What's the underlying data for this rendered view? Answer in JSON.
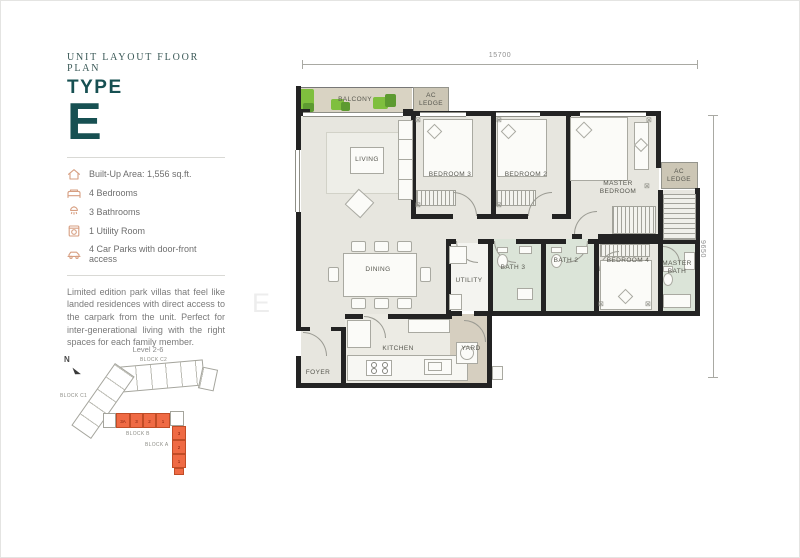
{
  "header": {
    "eyebrow": "UNIT LAYOUT FLOOR PLAN",
    "type_label": "TYPE",
    "type_letter": "E"
  },
  "features": {
    "items": [
      {
        "icon": "home-icon",
        "text": "Built-Up Area: 1,556 sq.ft."
      },
      {
        "icon": "bed-icon",
        "text": "4 Bedrooms"
      },
      {
        "icon": "shower-icon",
        "text": "3 Bathrooms"
      },
      {
        "icon": "washer-icon",
        "text": "1 Utility Room"
      },
      {
        "icon": "car-icon",
        "text": "4 Car Parks with door-front access"
      }
    ]
  },
  "description": "Limited edition park villas that feel like landed residences with direct access to the carpark from the unit. Perfect for inter-generational living with the right spaces for each family member.",
  "sitemap": {
    "title": "Level 2-6",
    "north_label": "N",
    "blocks": {
      "c2": "BLOCK C2",
      "c1": "BLOCK C1",
      "b": "BLOCK B",
      "a": "BLOCK A"
    },
    "block_b_units": [
      "3A",
      "3",
      "2",
      "1"
    ],
    "block_a_units": [
      "3",
      "2",
      "1"
    ]
  },
  "plan": {
    "dim_top": "15700",
    "dim_right": "9650",
    "rooms": {
      "balcony": "BALCONY",
      "ac_ledge_top": "AC LEDGE",
      "living": "LIVING",
      "bedroom3": "BEDROOM 3",
      "bedroom2": "BEDROOM 2",
      "master_bedroom": "MASTER BEDROOM",
      "ac_ledge_right": "AC LEDGE",
      "dining": "DINING",
      "utility": "UTILITY",
      "bath3": "BATH 3",
      "bath2": "BATH 2",
      "bedroom4": "BEDROOM 4",
      "master_bath": "MASTER BATH",
      "kitchen": "KITCHEN",
      "yard": "YARD",
      "foyer": "FOYER"
    }
  },
  "watermark": {
    "text": "EVARIS"
  },
  "colors": {
    "accent_teal": "#175052",
    "icon_salmon": "#d79f82",
    "highlight_orange": "#ef6a44",
    "bath_green": "#dbe4d8",
    "floor_grey": "#e7e6df",
    "ledge_tan": "#d9d3c3"
  }
}
